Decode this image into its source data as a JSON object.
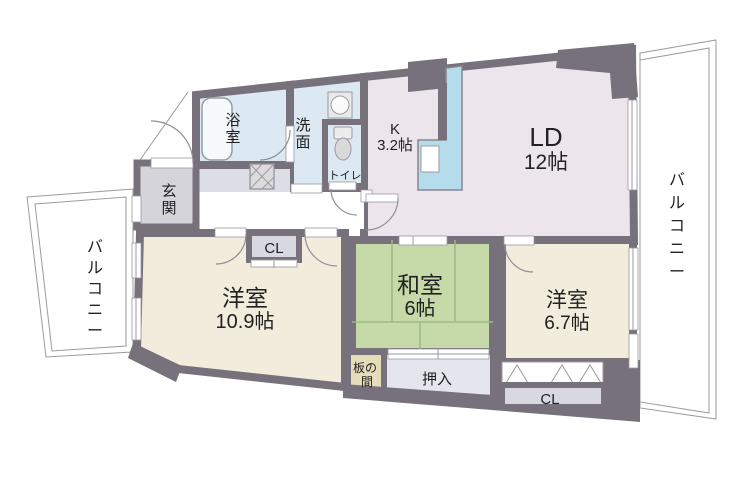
{
  "plan_title": "2LDK+和室 マンション間取り図",
  "rooms": {
    "living_dining": {
      "name": "LD",
      "size": "12帖"
    },
    "kitchen": {
      "name": "K",
      "size": "3.2帖"
    },
    "bathroom": {
      "name": "浴室"
    },
    "washroom": {
      "name": "洗面"
    },
    "toilet": {
      "name": "トイレ"
    },
    "entrance": {
      "name": "玄関"
    },
    "hall_closet": {
      "name": "CL"
    },
    "western_room_large": {
      "name": "洋室",
      "size": "10.9帖"
    },
    "japanese_room": {
      "name": "和室",
      "size": "6帖"
    },
    "itanoma": {
      "name_line1": "板の",
      "name_line2": "間"
    },
    "oshiire": {
      "name": "押入"
    },
    "western_room_small": {
      "name": "洋室",
      "size": "6.7帖"
    },
    "bedroom_closet": {
      "name": "CL"
    },
    "balcony_left": {
      "name": "バルコニー"
    },
    "balcony_right": {
      "name": "バルコニー"
    }
  },
  "colors": {
    "wall": "#76717a",
    "wet_area_blue": "#dce8f2",
    "living_pink": "#ece5eb",
    "western_cream": "#f1ecdb",
    "tatami_green": "#c5daa8",
    "entrance_gray": "#d5d4db",
    "closet_gray": "#d8d8e1",
    "oshiire_lavender": "#e5e5ee",
    "itanoma_tan": "#e5dcba",
    "counter_blue": "#b5dcea",
    "outline_thin": "#9a9aa2"
  }
}
